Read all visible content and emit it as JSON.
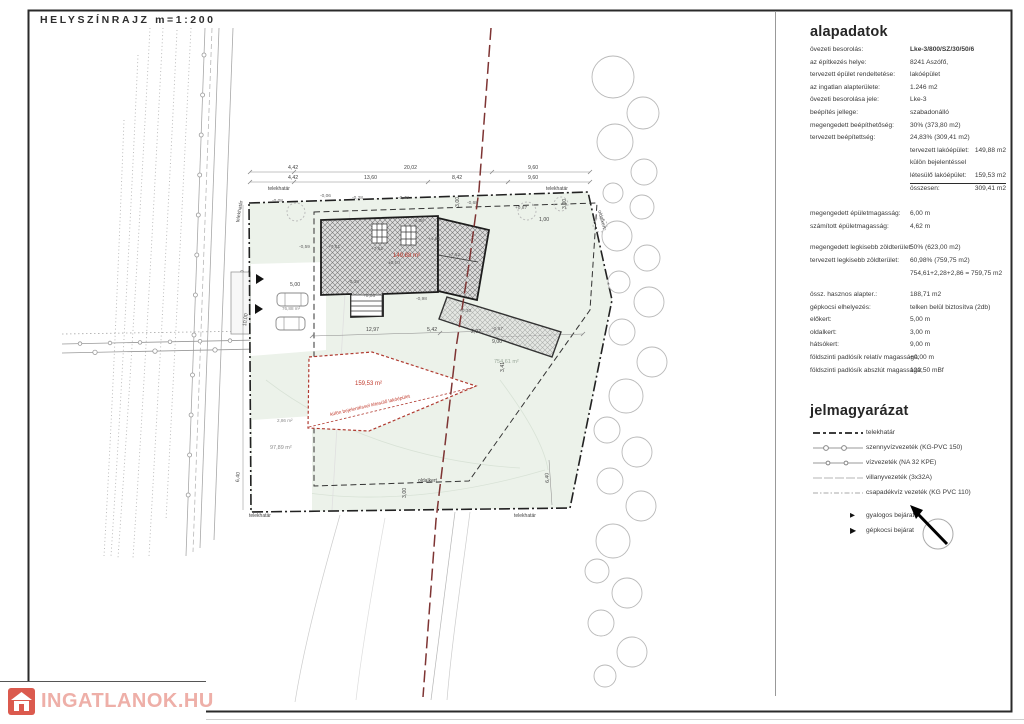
{
  "title": "HELYSZÍNRAJZ m=1:200",
  "watermark": {
    "text": "INGATLANOK.HU"
  },
  "colors": {
    "accent_red": "#c0392b",
    "boundary_red": "#7e3433",
    "plot_green": "#ecf2ea",
    "watermark_pink": "#eeafa8",
    "watermark_icon_red": "#db5a4e"
  },
  "info_panel": {
    "heading": "alapadatok",
    "rows1": [
      {
        "label": "övezeti besorolás:",
        "value": "Lke-3/800/SZ/30/50/6",
        "bold": true
      },
      {
        "label": "az építkezés helye:",
        "value": "8241 Aszófő,"
      },
      {
        "label": "tervezett épület rendeltetése:",
        "value": "lakóépület"
      },
      {
        "label": "az ingatlan alapterülete:",
        "value": "1.246 m2"
      },
      {
        "label": "övezeti besorolása jele:",
        "value": "Lke-3"
      },
      {
        "label": "beépítés jellege:",
        "value": "szabadonálló"
      },
      {
        "label": "megengedett beépíthetőség:",
        "value": "30% (373,80 m2)"
      },
      {
        "label": "tervezett beépítettség:",
        "value": "24,83% (309,41 m2)"
      }
    ],
    "sub_rows": [
      {
        "label": "tervezett lakóépület:",
        "value": "149,88 m2",
        "sub": true
      },
      {
        "label": "külön bejelentéssel",
        "value": "",
        "sub": true
      },
      {
        "label": "létesülő lakóépület:",
        "value": "159,53 m2",
        "sub": true,
        "underline": true
      },
      {
        "label": "összesen:",
        "value": "309,41 m2",
        "sub": true
      }
    ],
    "rows2": [
      {
        "label": "megengedett épületmagasság:",
        "value": "6,00 m"
      },
      {
        "label": "számított épületmagasság:",
        "value": "4,62 m"
      }
    ],
    "rows3": [
      {
        "label": "megengedett legkisebb zöldterület:",
        "value": "50% (623,00 m2)"
      },
      {
        "label": "tervezett legkisebb zöldterület:",
        "value": "60,98% (759,75 m2)"
      },
      {
        "label": "",
        "value": "754,61+2,28+2,86 = 759,75 m2"
      }
    ],
    "rows4": [
      {
        "label": "össz. hasznos alapter.:",
        "value": "188,71 m2"
      },
      {
        "label": "gépkocsi elhelyezés:",
        "value": "telken belül  biztosítva (2db)"
      },
      {
        "label": "előkert:",
        "value": "5,00 m"
      },
      {
        "label": "oldalkert:",
        "value": "3,00 m"
      },
      {
        "label": "hátsókert:",
        "value": "9,00 m"
      },
      {
        "label": "földszinti padlósík relatív magassága:",
        "value": "+0,00 m"
      },
      {
        "label": "földszinti padlósík abszlút magassága:",
        "value": "120,50 mBf"
      }
    ]
  },
  "legend": {
    "heading": "jelmagyarázat",
    "items": [
      {
        "label": "telekhatár",
        "style": "boundary"
      },
      {
        "label": "szennyvízvezeték (KG-PVC 150)",
        "style": "sewer"
      },
      {
        "label": "vízvezeték (NA 32 KPE)",
        "style": "water"
      },
      {
        "label": "villanyvezeték (3x32A)",
        "style": "electric"
      },
      {
        "label": "csapadékvíz vezeték (KG PVC 110)",
        "style": "storm"
      }
    ],
    "arrow_items": [
      {
        "label": "gyalogos bejárat",
        "style": "arrow-small"
      },
      {
        "label": "gépkocsi bejárat",
        "style": "arrow-large"
      }
    ]
  },
  "plan": {
    "areas": [
      {
        "t": "149,88 m²",
        "x": 393,
        "y": 253,
        "c": "#c0392b",
        "s": 6
      },
      {
        "t": "159,53 m²",
        "x": 355,
        "y": 381,
        "c": "#c0392b",
        "s": 6
      },
      {
        "t": "külön bejelentéssel létesülő lakóépület",
        "x": 330,
        "y": 414,
        "c": "#c0392b",
        "s": 4.8,
        "r": -13
      },
      {
        "t": "754,61 m²",
        "x": 494,
        "y": 360,
        "c": "#9aa89a",
        "s": 5.5
      },
      {
        "t": "97,89 m²",
        "x": 270,
        "y": 446,
        "c": "#8a8a8a",
        "s": 5.5
      },
      {
        "t": "2,86 m²",
        "x": 277,
        "y": 419,
        "c": "#8a8a8a",
        "s": 4.6
      },
      {
        "t": "76,88 m²",
        "x": 282,
        "y": 307,
        "c": "#8a8a8a",
        "s": 4.6
      }
    ],
    "boundary_labels": [
      {
        "t": "telekhatár",
        "x": 268,
        "y": 187
      },
      {
        "t": "telekhatár",
        "x": 546,
        "y": 187
      },
      {
        "t": "telekhatár",
        "x": 249,
        "y": 514
      },
      {
        "t": "telekhatár",
        "x": 514,
        "y": 514
      },
      {
        "t": "telekhatár",
        "x": 236,
        "y": 222,
        "r": -80
      },
      {
        "t": "oldalkert",
        "x": 418,
        "y": 479
      },
      {
        "t": "oldalkert",
        "x": 601,
        "y": 210,
        "r": 75
      }
    ],
    "dims": [
      {
        "t": "4,42",
        "x": 288,
        "y": 166
      },
      {
        "t": "20,02",
        "x": 404,
        "y": 166
      },
      {
        "t": "9,60",
        "x": 528,
        "y": 166
      },
      {
        "t": "4,42",
        "x": 288,
        "y": 176
      },
      {
        "t": "13,60",
        "x": 364,
        "y": 176
      },
      {
        "t": "8,42",
        "x": 452,
        "y": 176
      },
      {
        "t": "9,60",
        "x": 528,
        "y": 176
      },
      {
        "t": "12,97",
        "x": 366,
        "y": 328
      },
      {
        "t": "5,42",
        "x": 427,
        "y": 328
      },
      {
        "t": "2,92",
        "x": 471,
        "y": 330
      },
      {
        "t": "9,00",
        "x": 492,
        "y": 340
      },
      {
        "t": "3,41",
        "x": 501,
        "y": 372,
        "r": -90
      },
      {
        "t": "5,00",
        "x": 290,
        "y": 283
      },
      {
        "t": "10,00",
        "x": 243,
        "y": 326,
        "r": -82
      },
      {
        "t": "3,00",
        "x": 403,
        "y": 498,
        "r": -90
      },
      {
        "t": "6,40",
        "x": 236,
        "y": 482,
        "r": -86
      },
      {
        "t": "6,40",
        "x": 546,
        "y": 483,
        "r": -94
      },
      {
        "t": "3,00",
        "x": 456,
        "y": 207,
        "r": -90
      },
      {
        "t": "3,00",
        "x": 563,
        "y": 209,
        "r": -90
      },
      {
        "t": "1,00",
        "x": 539,
        "y": 218
      }
    ],
    "levels": [
      {
        "t": "-0,06",
        "x": 320,
        "y": 195
      },
      {
        "t": "-0,08",
        "x": 272,
        "y": 200
      },
      {
        "t": "-0,28",
        "x": 352,
        "y": 197
      },
      {
        "t": "-0,48",
        "x": 398,
        "y": 197
      },
      {
        "t": "-0,68",
        "x": 467,
        "y": 202
      },
      {
        "t": "+0,87",
        "x": 515,
        "y": 207
      },
      {
        "t": "+7,61",
        "x": 328,
        "y": 246
      },
      {
        "t": "+7,62",
        "x": 371,
        "y": 248
      },
      {
        "t": "+7,62",
        "x": 448,
        "y": 254
      },
      {
        "t": "-0,08",
        "x": 413,
        "y": 220
      },
      {
        "t": "±0,00",
        "x": 388,
        "y": 262
      },
      {
        "t": "-0,59",
        "x": 299,
        "y": 246
      },
      {
        "t": "+4,62",
        "x": 428,
        "y": 238
      },
      {
        "t": "-0,38",
        "x": 348,
        "y": 281
      },
      {
        "t": "+0,06",
        "x": 363,
        "y": 295
      },
      {
        "t": "-0,98",
        "x": 416,
        "y": 298
      },
      {
        "t": "+0,30",
        "x": 459,
        "y": 310
      },
      {
        "t": "-0,97",
        "x": 492,
        "y": 328
      }
    ]
  }
}
